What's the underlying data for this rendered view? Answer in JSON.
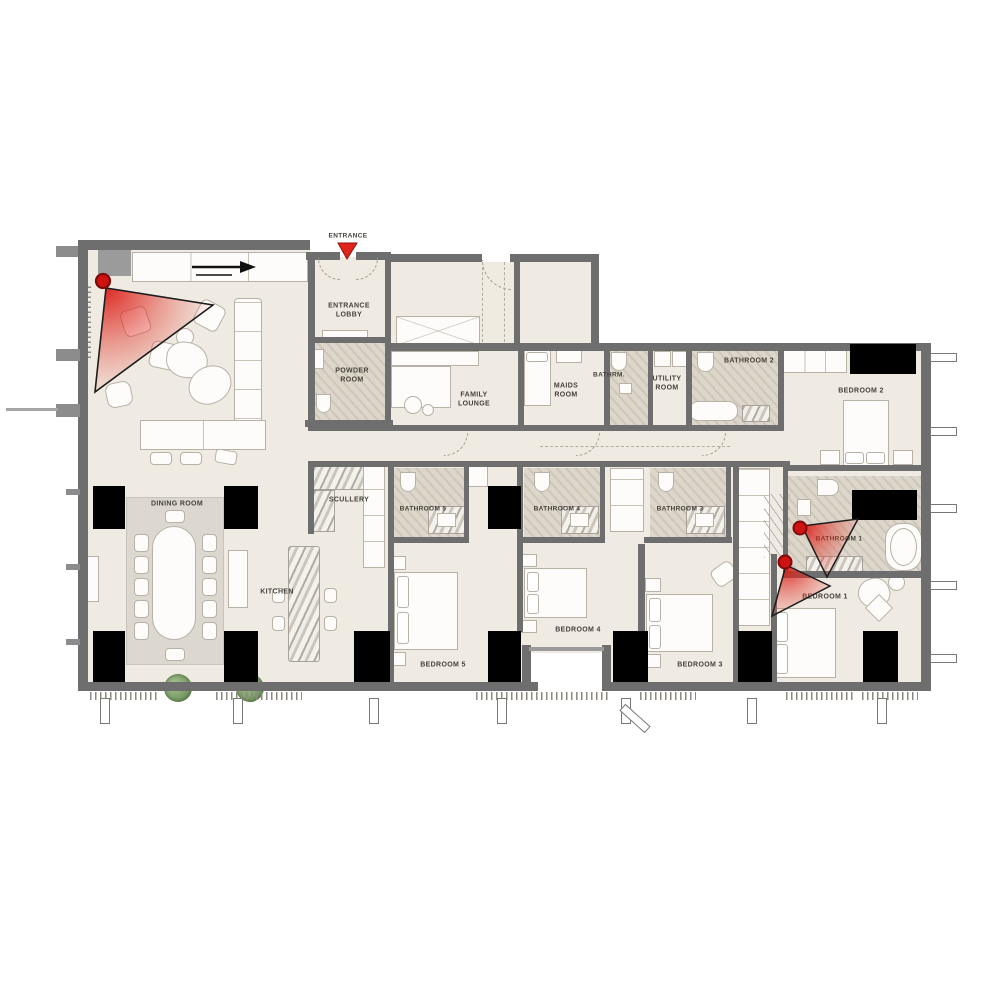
{
  "rooms": [
    {
      "id": "entrance",
      "label": "ENTRANCE"
    },
    {
      "id": "entrance-lobby",
      "label": "ENTRANCE\nLOBBY"
    },
    {
      "id": "powder-room",
      "label": "POWDER\nROOM"
    },
    {
      "id": "family-lounge",
      "label": "FAMILY\nLOUNGE"
    },
    {
      "id": "maids-room",
      "label": "MAIDS\nROOM"
    },
    {
      "id": "bathrm",
      "label": "BATHRM."
    },
    {
      "id": "utility-room",
      "label": "UTILITY\nROOM"
    },
    {
      "id": "bathroom-2",
      "label": "BATHROOM 2"
    },
    {
      "id": "bedroom-2",
      "label": "BEDROOM 2"
    },
    {
      "id": "dining-room",
      "label": "DINING ROOM"
    },
    {
      "id": "scullery",
      "label": "SCULLERY"
    },
    {
      "id": "kitchen",
      "label": "KITCHEN"
    },
    {
      "id": "bathroom-5",
      "label": "BATHROOM 5"
    },
    {
      "id": "bathroom-4",
      "label": "BATHROOM 4"
    },
    {
      "id": "bathroom-3",
      "label": "BATHROOM 3"
    },
    {
      "id": "bedroom-5",
      "label": "BEDROOM 5"
    },
    {
      "id": "bedroom-4",
      "label": "BEDROOM 4"
    },
    {
      "id": "bedroom-3",
      "label": "BEDROOM 3"
    },
    {
      "id": "bathroom-1",
      "label": "BATHROOM 1"
    },
    {
      "id": "bedroom-1",
      "label": "BEDROOM 1"
    }
  ],
  "markers": {
    "entrance_triangle_icon": "entrance-triangle-icon",
    "cameras": [
      {
        "id": "camera-living-room",
        "icon": "camera-dot-icon",
        "coverage": "living-room"
      },
      {
        "id": "camera-bathroom-1",
        "icon": "camera-dot-icon",
        "coverage": "bathroom-1"
      },
      {
        "id": "camera-bedroom-1",
        "icon": "camera-dot-icon",
        "coverage": "bedroom-1"
      }
    ]
  },
  "colors": {
    "floor": "#f0ebe2",
    "wall": "#6e6e6e",
    "column": "#000000",
    "camera_red": "#cf1212",
    "cone_red": "#e03a2e",
    "entrance_red": "#e0261c",
    "label_text": "#45423b",
    "bath_tile": "#ddd6ca",
    "rug": "#dcd8d0",
    "plant_green": "#7fa06c"
  }
}
